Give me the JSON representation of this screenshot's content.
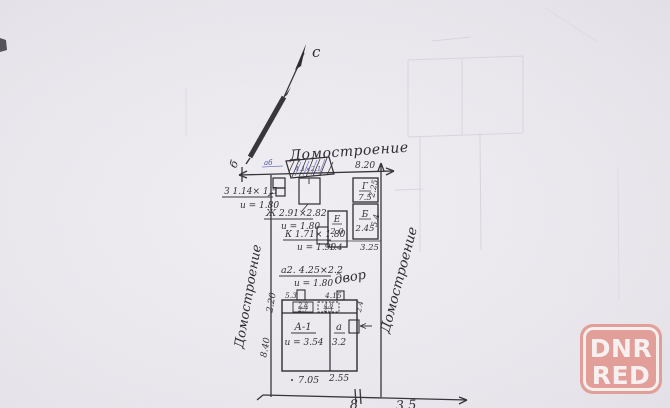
{
  "plan": {
    "compass_label": "с",
    "corner_letter": "б",
    "street_top": "Домостроение",
    "street_left": "Домостроение",
    "street_right": "Домостроение",
    "yard_label": "двор",
    "notes": {
      "z": {
        "line1": "З 1.14× 1.5",
        "line2": "и = 1.80"
      },
      "zh": {
        "line1": "Ж 2.91×2.82",
        "line2": "и = 1.80"
      },
      "k": {
        "line1": "К 1.71× 1.80",
        "line2": "и = 1.90"
      },
      "a2": {
        "line1": "а2. 4.25×2.2",
        "line2": "и = 1.80"
      }
    },
    "buildings": {
      "g": {
        "letter": "Г",
        "value": "7.5"
      },
      "b": {
        "letter": "Б",
        "value": "2.45"
      },
      "e": {
        "letter": "Е",
        "value": "2.0"
      },
      "a1": {
        "letter": "А-1",
        "value": "и = 3.54"
      },
      "a": {
        "letter": "а",
        "value": "3.2"
      }
    },
    "dims": {
      "top": "8.20",
      "right_upper": "2.25",
      "right_mid": "5.4",
      "row_left": "1.4",
      "row_right": "3.25",
      "left_upper": "2.20",
      "left_lower": "8.40",
      "house_top_left": "5.3",
      "house_top_right": "4.15",
      "cell_left_top": "2.8",
      "cell_left_bot": "2.7",
      "cell_right_top": "4.8",
      "cell_right_bot": "2.1",
      "house_right": "2.4",
      "bottom_left": "7.05",
      "bottom_right": "2.55"
    },
    "ink_note": {
      "small": "аб",
      "text": "4.1×2.1"
    },
    "bottom_fragment1": "8",
    "bottom_fragment2": "3.5"
  },
  "watermark": {
    "line1": "DNR",
    "line2": "RED",
    "color": "#e29b94"
  }
}
